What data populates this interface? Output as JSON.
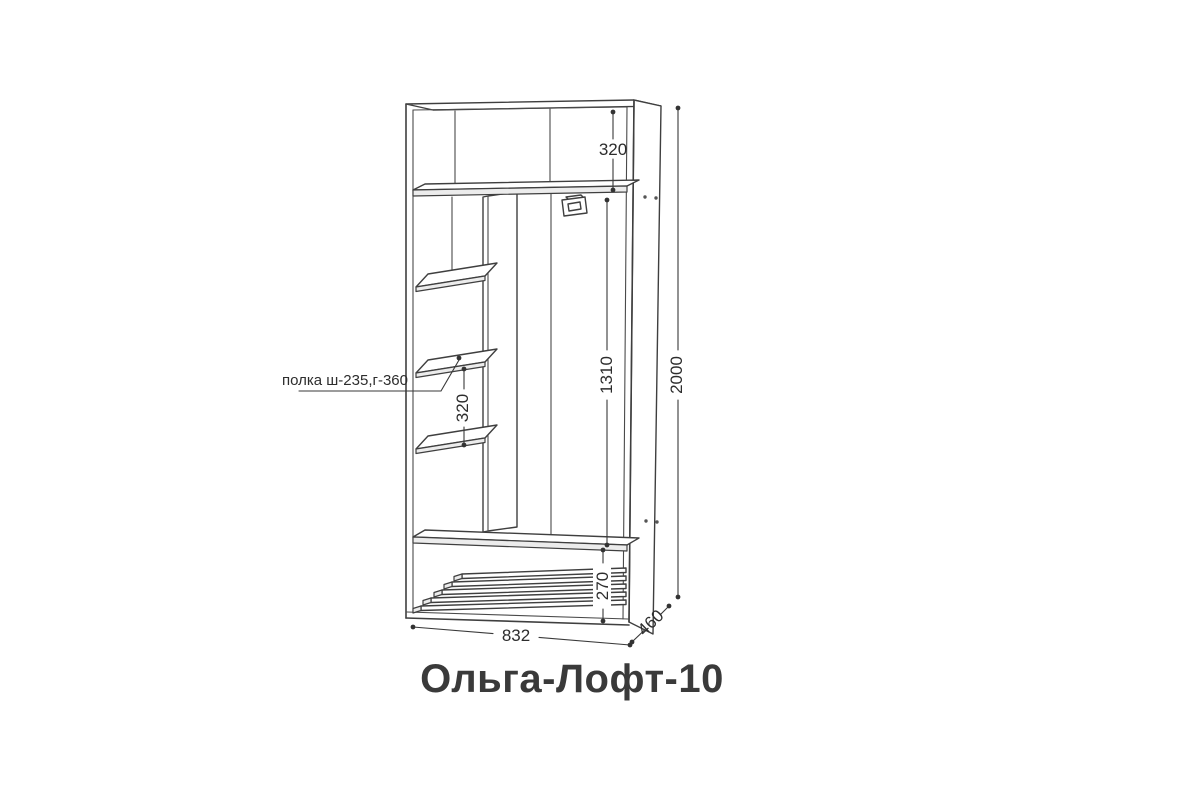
{
  "title": "Ольга-Лофт-10",
  "annotation": {
    "shelf_label": "полка ш-235,г-360"
  },
  "dimensions": {
    "top_section": "320",
    "hanging_section": "1310",
    "left_shelf_gap": "320",
    "bottom_section": "270",
    "height": "2000",
    "width": "832",
    "depth": "460"
  },
  "colors": {
    "line": "#3f3f3f",
    "text": "#2d2d2d",
    "title": "#3a3a3a",
    "background": "#ffffff"
  }
}
